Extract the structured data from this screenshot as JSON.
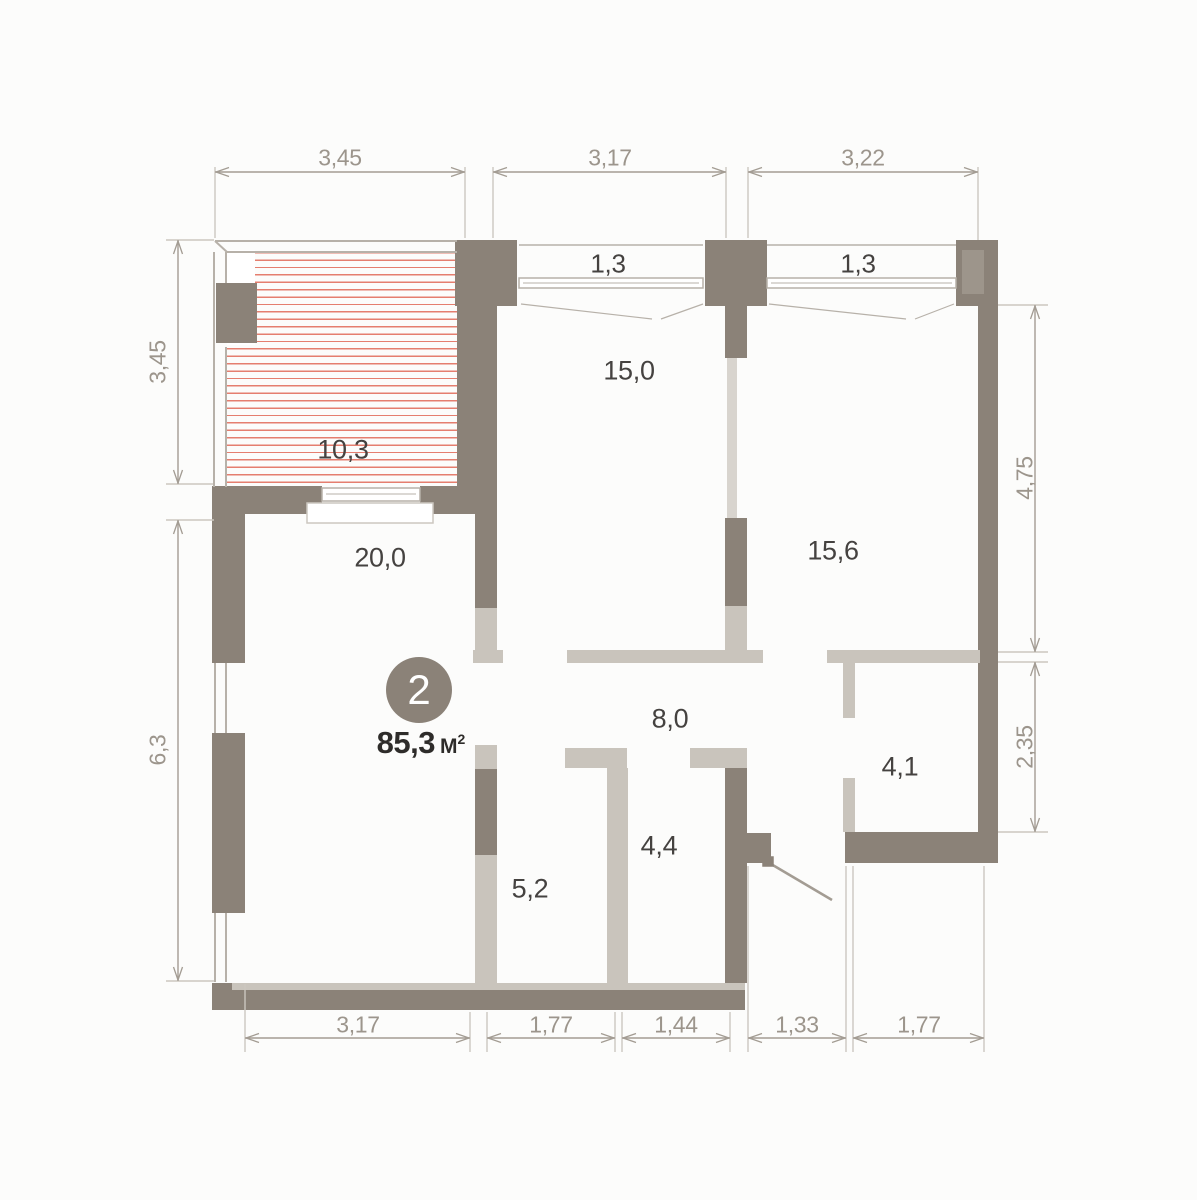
{
  "unit": {
    "number": "2",
    "area": "85,3",
    "area_unit": "М",
    "area_unit_sup": "2"
  },
  "rooms": {
    "balcony": "10,3",
    "room_top_mid": "15,0",
    "room_top_right": "15,6",
    "room_left": "20,0",
    "hallway": "8,0",
    "room_mid_small": "4,4",
    "room_bottom_left_small": "5,2",
    "room_right_small": "4,1"
  },
  "windows": {
    "left_window": "1,3",
    "right_window": "1,3"
  },
  "dimensions": {
    "top": [
      "3,45",
      "3,17",
      "3,22"
    ],
    "bottom": [
      "3,17",
      "1,77",
      "1,44",
      "1,33",
      "1,77"
    ],
    "left": [
      "3,45",
      "6,3"
    ],
    "right": [
      "4,75",
      "2,35"
    ]
  },
  "colors": {
    "background": "#fcfcfb",
    "wall_dark": "#8b8278",
    "wall_light": "#c9c4bc",
    "wall_thin": "#d8d4ce",
    "wall_medium": "#9d958b",
    "hatch_red": "#df5f4c",
    "glaze": "#b7b1a9",
    "ext_line": "#ccc7c0",
    "dim_line": "#a39c93",
    "dim_text": "#9c958c",
    "label_text": "#454240",
    "badge_fill": "#8b8278",
    "badge_text": "#ffffff"
  }
}
